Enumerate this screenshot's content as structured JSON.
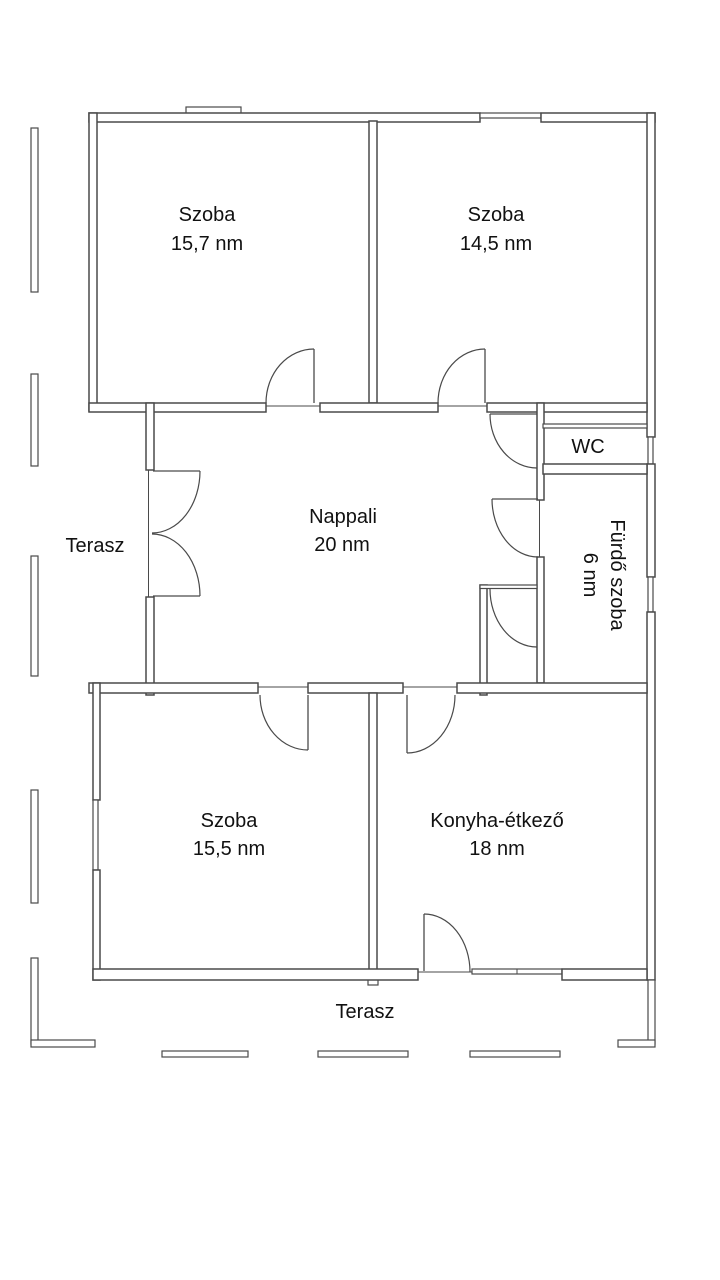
{
  "plan": {
    "rooms": [
      {
        "name": "Szoba",
        "area": "15,7 nm"
      },
      {
        "name": "Szoba",
        "area": "14,5 nm"
      },
      {
        "name": "Nappali",
        "area": "20 nm"
      },
      {
        "name": "WC"
      },
      {
        "name": "Fürdő szoba",
        "area": "6 nm"
      },
      {
        "name": "Szoba",
        "area": "15,5 nm"
      },
      {
        "name": "Konyha-étkező",
        "area": "18 nm"
      }
    ],
    "terrace_left": "Terasz",
    "terrace_bottom": "Terasz"
  },
  "colors": {
    "wall": "#4a4a4a",
    "text": "#111111",
    "background": "#ffffff"
  }
}
